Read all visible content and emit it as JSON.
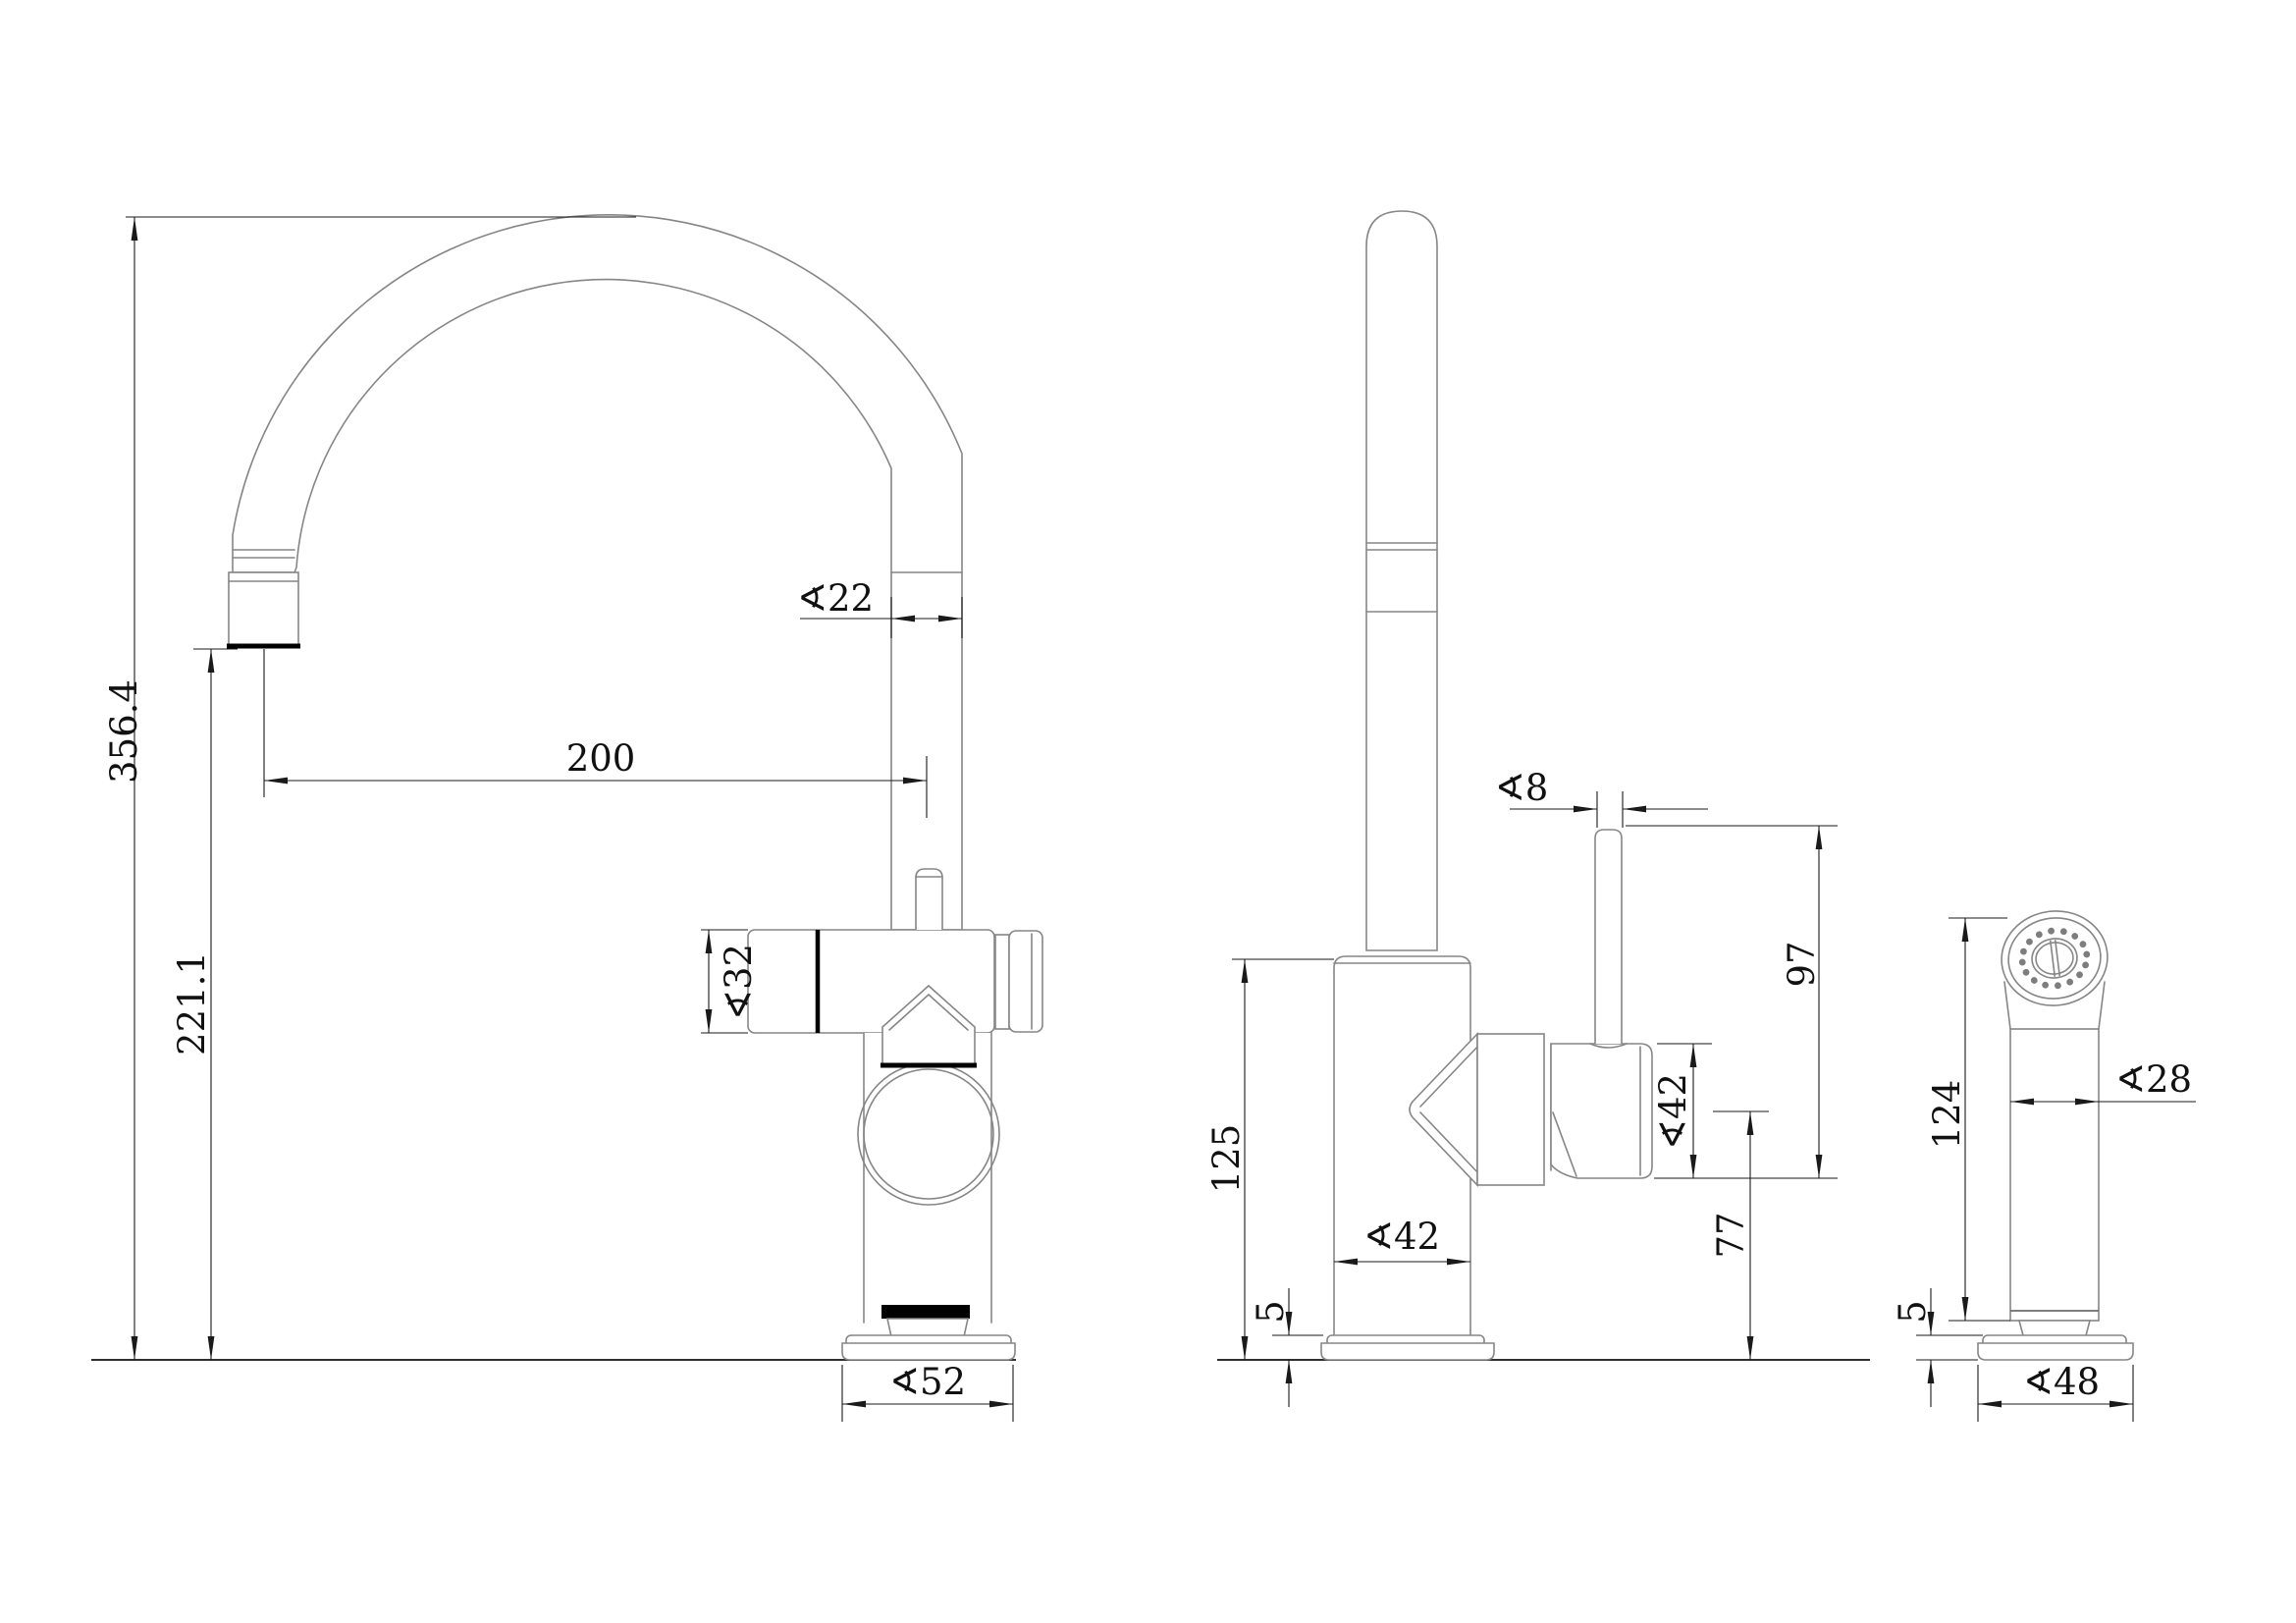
{
  "drawing": {
    "type": "technical-dimension-drawing",
    "subject": "kitchen faucet with gooseneck spout and side sprayer, three orthographic views",
    "units": "mm",
    "colors": {
      "background": "#ffffff",
      "object_line": "#868686",
      "dimension_line": "#1a1a1a",
      "accent_line": "#000000"
    },
    "front_view": {
      "total_height": "356.4",
      "outlet_height": "221.1",
      "spout_reach": "200",
      "spout_tube_diameter": "∢22",
      "valve_body_diameter": "∢32",
      "base_diameter": "∢52"
    },
    "side_view": {
      "body_height": "125",
      "base_plate_thickness": "5",
      "body_diameter": "∢42",
      "handle_diameter": "∢42",
      "lever_diameter": "∢8",
      "lever_height": "97",
      "handle_axis_height": "77"
    },
    "sprayer_view": {
      "height": "124",
      "base_plate_thickness": "5",
      "head_diameter": "∢28",
      "base_diameter": "∢48"
    }
  }
}
